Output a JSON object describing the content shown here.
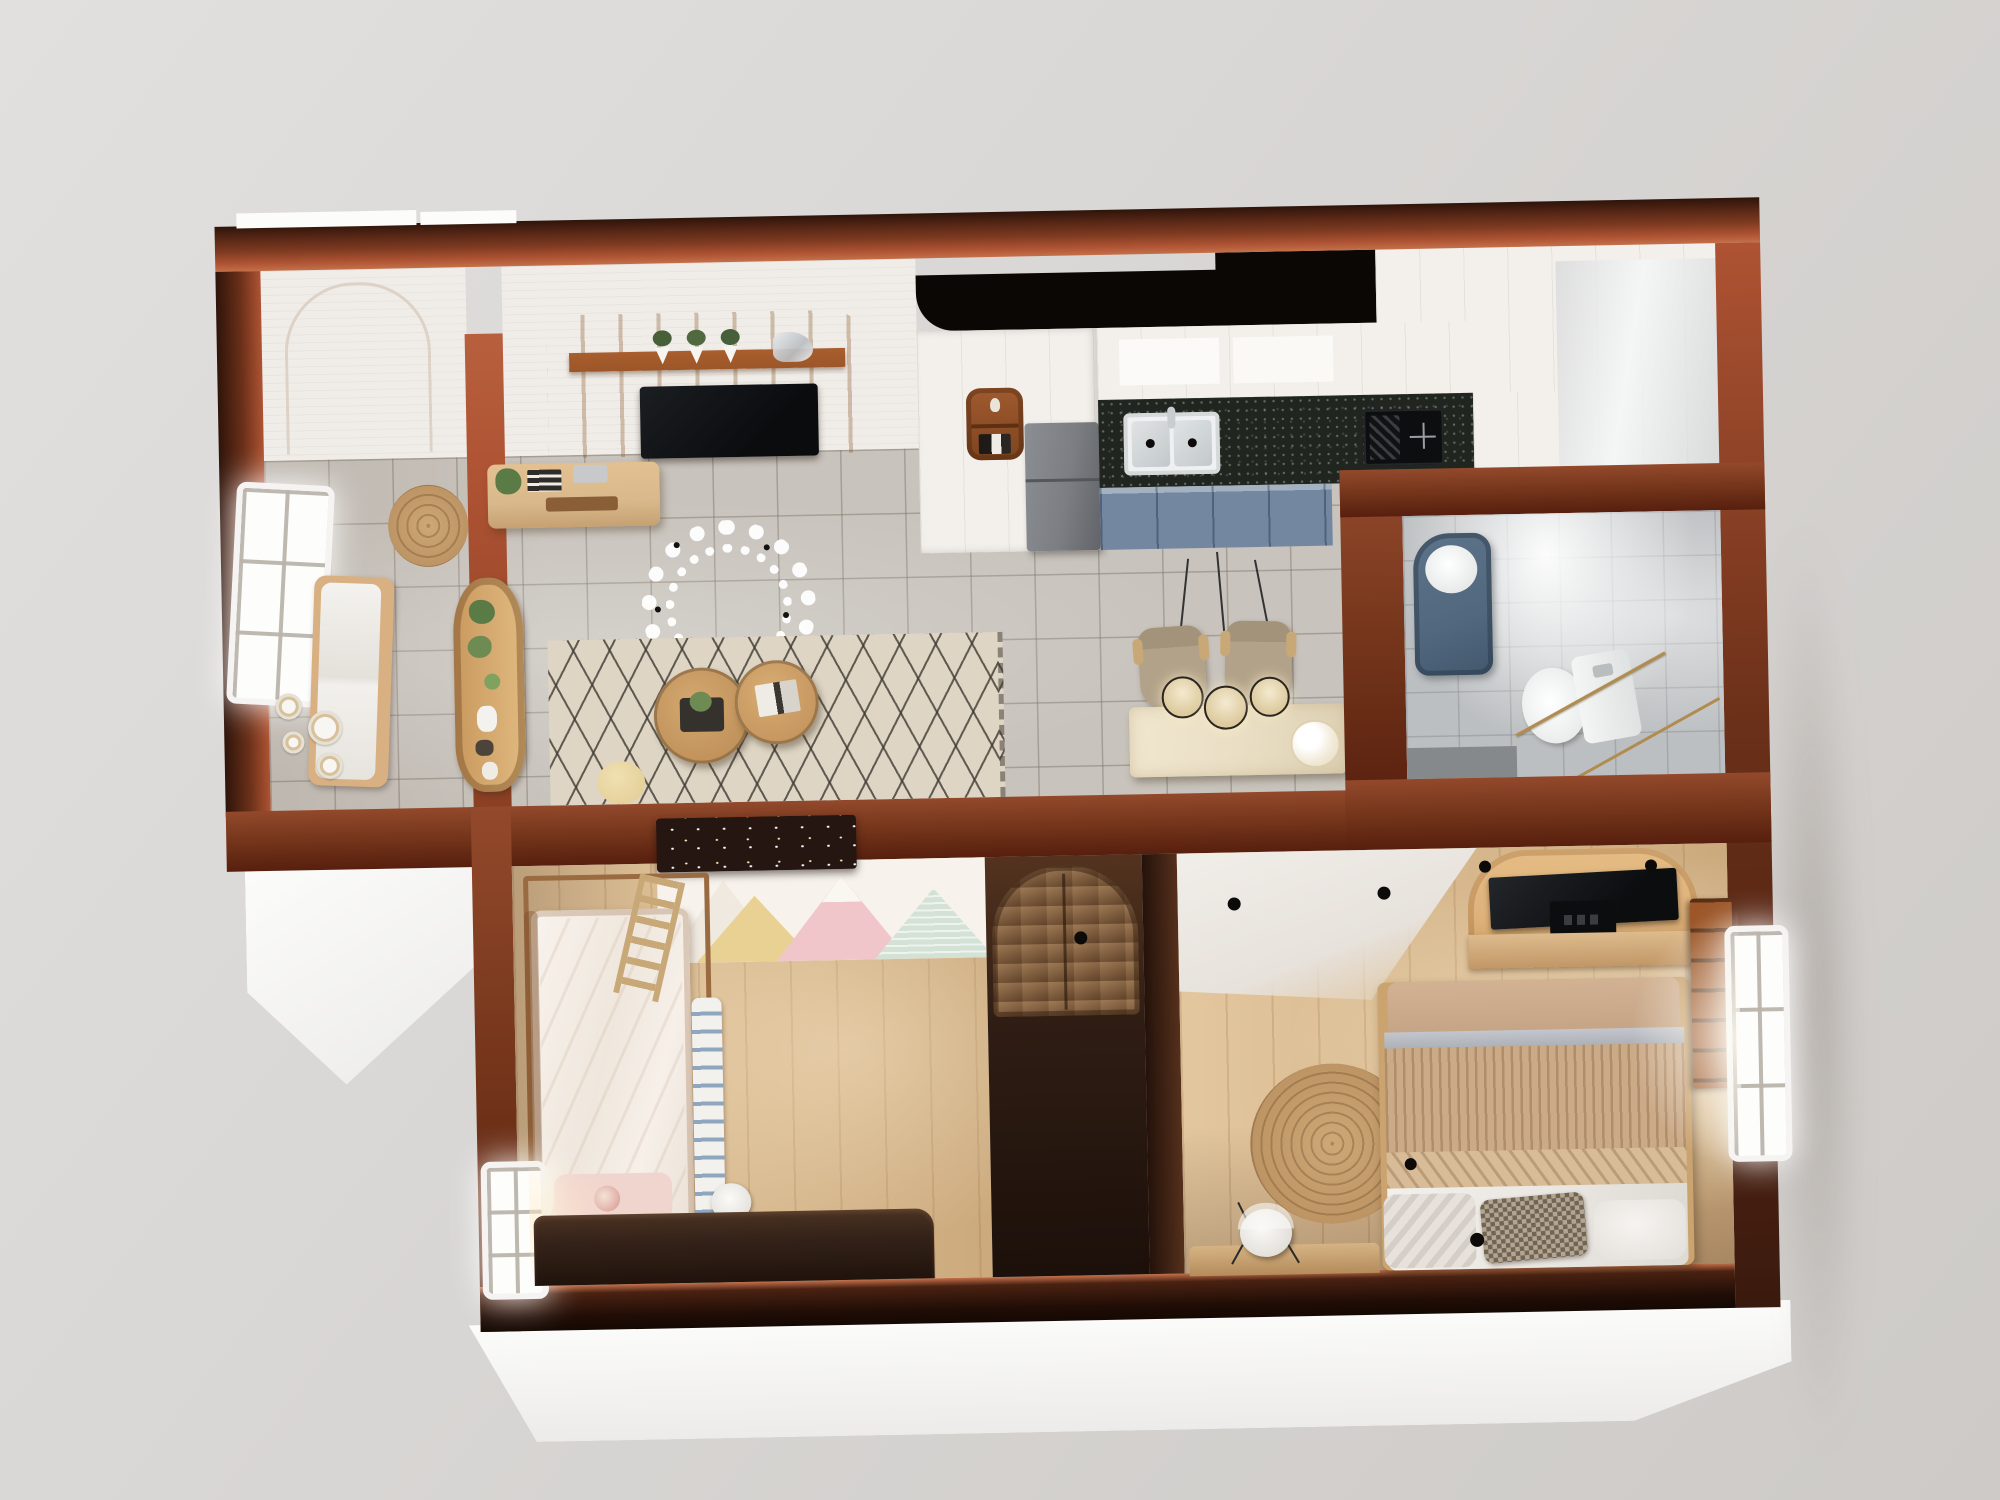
{
  "scene": {
    "type": "3d-apartment-floorplan-render",
    "view": "top-down-dollhouse",
    "rooms": [
      {
        "name": "entry-hall",
        "floor": "gray-ceramic-tile",
        "items": [
          "side-window",
          "seating-bench",
          "round-jute-mat",
          "decorative-wall-plates",
          "arched-display-shelf-with-plants"
        ]
      },
      {
        "name": "living-room",
        "floor": "gray-ceramic-tile",
        "items": [
          "slatted-tv-wall-panel",
          "shelf-with-three-planters",
          "glass-sculpture",
          "television",
          "wood-media-console",
          "leaf-wreath-chandelier",
          "geometric-cube-rug",
          "nesting-round-coffee-tables",
          "cream-pouf"
        ]
      },
      {
        "name": "kitchen",
        "floor": "gray-ceramic-tile",
        "items": [
          "black-ceiling-recess",
          "tall-white-cabinets",
          "arched-niche-shelf",
          "refrigerator",
          "granite-countertop",
          "double-bowl-sink",
          "gas-cooktop",
          "blue-base-cabinets",
          "white-end-cabinet"
        ]
      },
      {
        "name": "dining-area",
        "floor": "gray-ceramic-tile",
        "items": [
          "marble-dining-table",
          "two-tan-armchairs",
          "three-caged-pendant-lights",
          "white-flower-bouquet",
          "plate-gallery-wall"
        ]
      },
      {
        "name": "bathroom",
        "floor": "gray-tile",
        "items": [
          "blue-vanity-with-round-basin",
          "toilet",
          "gold-framed-glass-partition",
          "shower-area"
        ]
      },
      {
        "name": "kids-bedroom",
        "floor": "light-oak",
        "items": [
          "mountain-mural-wallpaper",
          "loft-cabinet-with-string-lights",
          "canopy-bed-frame",
          "wood-ladder",
          "white-pink-bed",
          "striped-blanket",
          "fairy-lights",
          "side-window",
          "dark-desk",
          "white-chair"
        ]
      },
      {
        "name": "hallway",
        "floor": "dark-wood",
        "items": [
          "arched-two-door-wardrobe"
        ]
      },
      {
        "name": "master-bedroom",
        "floor": "light-oak",
        "items": [
          "arched-tv-panel",
          "television",
          "media-device",
          "tv-console",
          "double-bed",
          "ribbed-tan-blanket",
          "houndstooth-pillow",
          "white-pillow",
          "round-jute-rug",
          "desk",
          "white-desk-chair",
          "bright-window",
          "wall-bookshelf",
          "ceiling-spotlights"
        ]
      }
    ]
  },
  "colors": {
    "bg": "#d8d6d4",
    "foundation": "#fbfbfa",
    "wall_top_dark": "#2e140a",
    "wall_mid": "#7c3a20",
    "wall_light": "#ae5333",
    "wall_highlight": "#c4704a",
    "ceiling_white": "#f0ece7",
    "recess_black": "#0a0705",
    "tile": "#c8c3bc",
    "wood": "#d8b88c",
    "rug_base": "#ded5c5",
    "tv_panel": "#dfb27b",
    "tv_shelf": "#9c5628",
    "tv_black": "#101214",
    "console_wood": "#d9b98c",
    "kitchen_white": "#f3f0ec",
    "counter": "#20261f",
    "cabinet_blue": "#7487a0",
    "fridge": "#7b7e82",
    "table_marble": "#eadfc5",
    "chair_tan": "#b2a289",
    "pendant_shade": "#eadfc0",
    "bath_floor": "#bcbfc1",
    "bath_blue": "#52687f",
    "toilet": "#f4f5f4",
    "gold": "#b08c50",
    "wallpaper_bg": "#f7f2eb",
    "mountain_pink": "#f0c6cb",
    "mountain_yellow": "#e9d193",
    "mountain_mint": "#d3e2d5",
    "kid_bed": "#f6f0e9",
    "kid_pillow": "#f0d5cf",
    "stripe_blue": "#8fa6bf",
    "loft_dark": "#261611",
    "wardrobe_wood": "#7e5a3a",
    "corridor_dark": "#2f1d14",
    "headboard": "#c6a587",
    "blanket": "#cbaa88",
    "sheet": "#eae7e2",
    "hound": "#b3a58f",
    "jute": "#c39a6a",
    "desk_dark": "#342219",
    "plant_green": "#5a7a46",
    "pot_white": "#f6f5f2"
  }
}
